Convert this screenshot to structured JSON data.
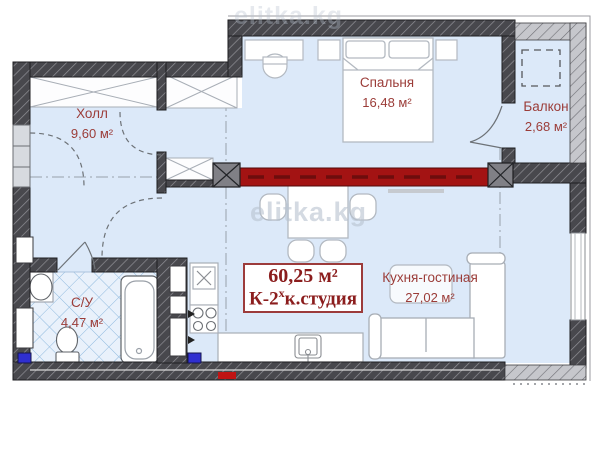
{
  "plan": {
    "watermarks": {
      "center": "elitka.kg",
      "top": "elitka.kg"
    },
    "rooms": {
      "hall": {
        "name": "Холл",
        "area": "9,60 м²"
      },
      "bedroom": {
        "name": "Спальня",
        "area": "16,48 м²"
      },
      "balcony": {
        "name": "Балкон",
        "area": "2,68 м²"
      },
      "bathroom": {
        "name": "С/У",
        "area": "4,47 м²"
      },
      "kitchen_living": {
        "name": "Кухня-гостиная",
        "area": "27,02 м²"
      }
    },
    "summary": {
      "total_area": "60,25 м²",
      "type_prefix": "К-2",
      "type_superscript": "х",
      "type_suffix": "к.студия"
    },
    "colors": {
      "accent_wall_red": "#a31313",
      "wall_dark": "#48484d",
      "wall_light": "#c6c7cc",
      "floor_blue": "#dce9f9",
      "tile_line_blue": "#8fb9de",
      "label_maroon": "#9b3c38",
      "marker_blue": "#2f2fd0"
    }
  }
}
